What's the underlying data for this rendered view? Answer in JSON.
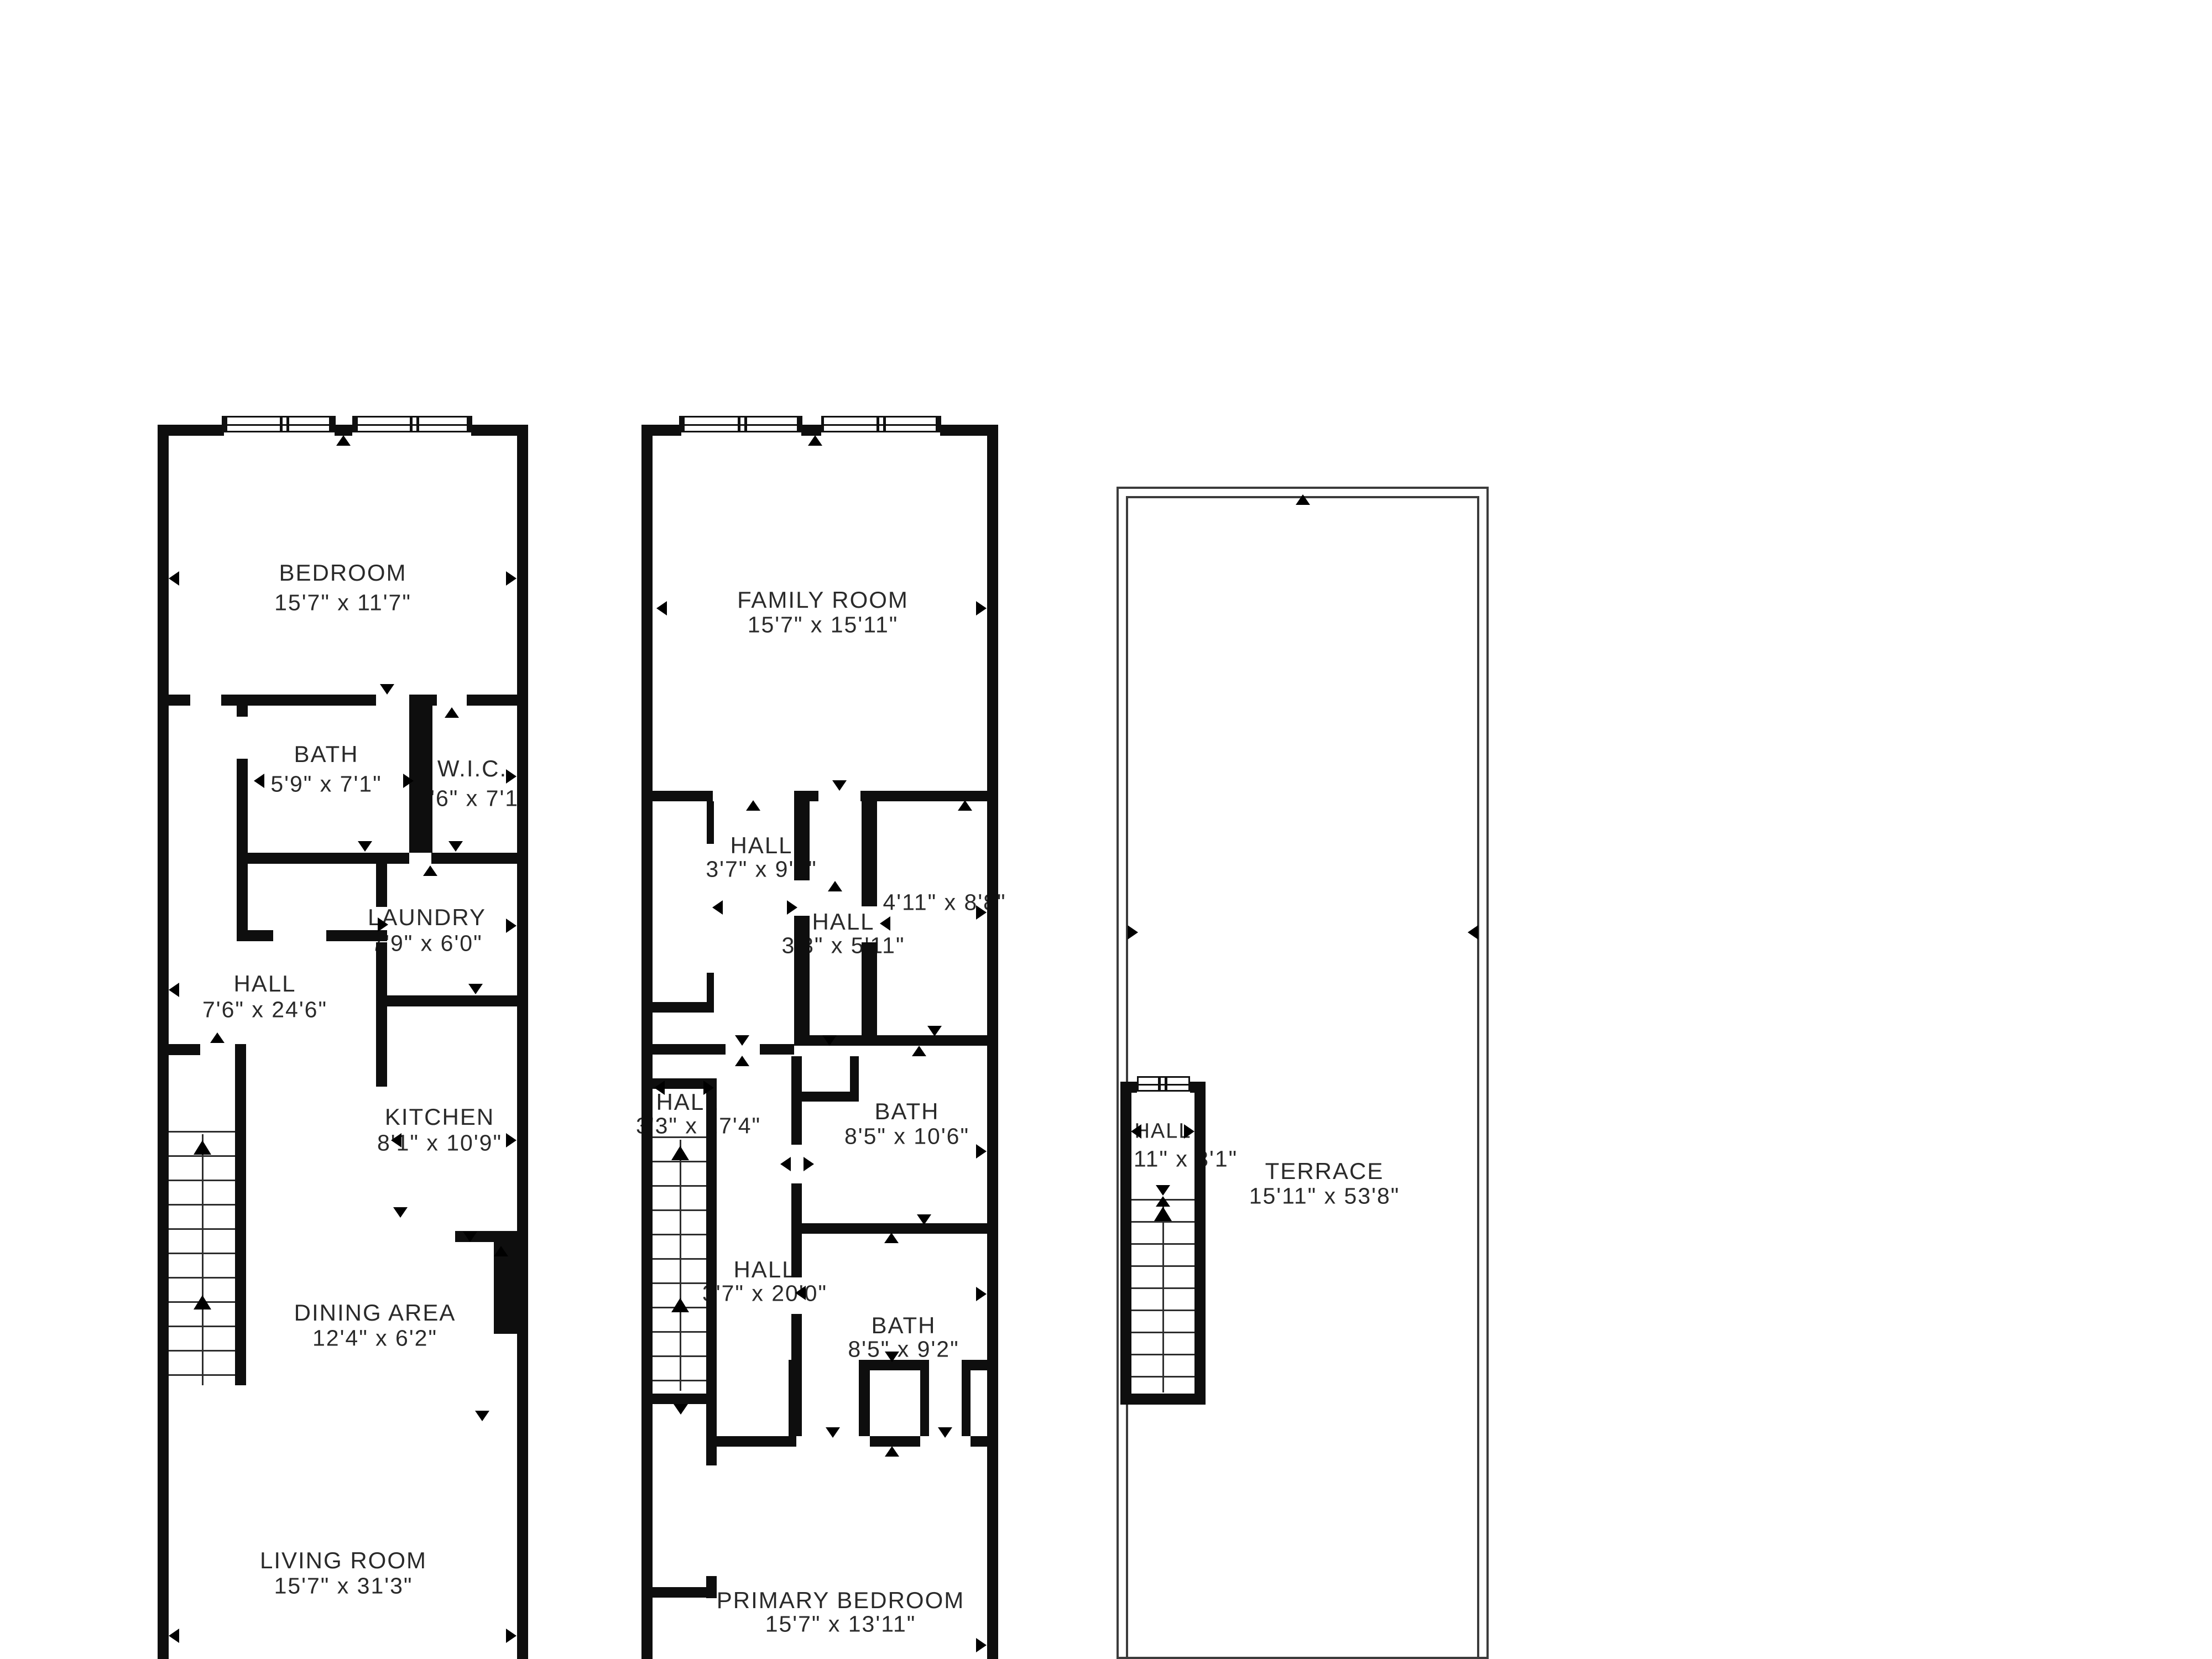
{
  "floor1": {
    "bedroom": {
      "name": "BEDROOM",
      "dims": "15'7\" x 11'7\""
    },
    "bath": {
      "name": "BATH",
      "dims": "5'9\" x 7'1\""
    },
    "wic": {
      "name": "W.I.C.",
      "dims": "5'6\" x 7'1\""
    },
    "laundry": {
      "name": "LAUNDRY",
      "dims": "7'9\" x 6'0\""
    },
    "hall": {
      "name": "HALL",
      "dims": "7'6\" x 24'6\""
    },
    "kitchen": {
      "name": "KITCHEN",
      "dims": "8'1\" x 10'9\""
    },
    "dining": {
      "name": "DINING AREA",
      "dims": "12'4\" x 6'2\""
    },
    "living": {
      "name": "LIVING ROOM",
      "dims": "15'7\" x 31'3\""
    }
  },
  "floor2": {
    "family": {
      "name": "FAMILY ROOM",
      "dims": "15'7\" x 15'11\""
    },
    "hall_upper": {
      "name": "HALL",
      "dims": "3'7\" x 9'0\""
    },
    "room_small": {
      "dims": "4'11\" x 8'8\""
    },
    "hall_center": {
      "name": "HALL",
      "dims": "3'3\" x 5'11\""
    },
    "hall_stairs": {
      "name": "HALL",
      "dims": "3'3\" x 17'4\""
    },
    "bath_upper": {
      "name": "BATH",
      "dims": "8'5\" x 10'6\""
    },
    "hall_lower": {
      "name": "HALL",
      "dims": "3'7\" x 20'0\""
    },
    "bath_lower": {
      "name": "BATH",
      "dims": "8'5\" x 9'2\""
    },
    "primary": {
      "name": "PRIMARY BEDROOM",
      "dims": "15'7\" x 13'11\""
    }
  },
  "terrace": {
    "hall": {
      "name": "HALL",
      "dims": "'11\" x 3'1\""
    },
    "terrace": {
      "name": "TERRACE",
      "dims": "15'11\" x 53'8\""
    }
  }
}
